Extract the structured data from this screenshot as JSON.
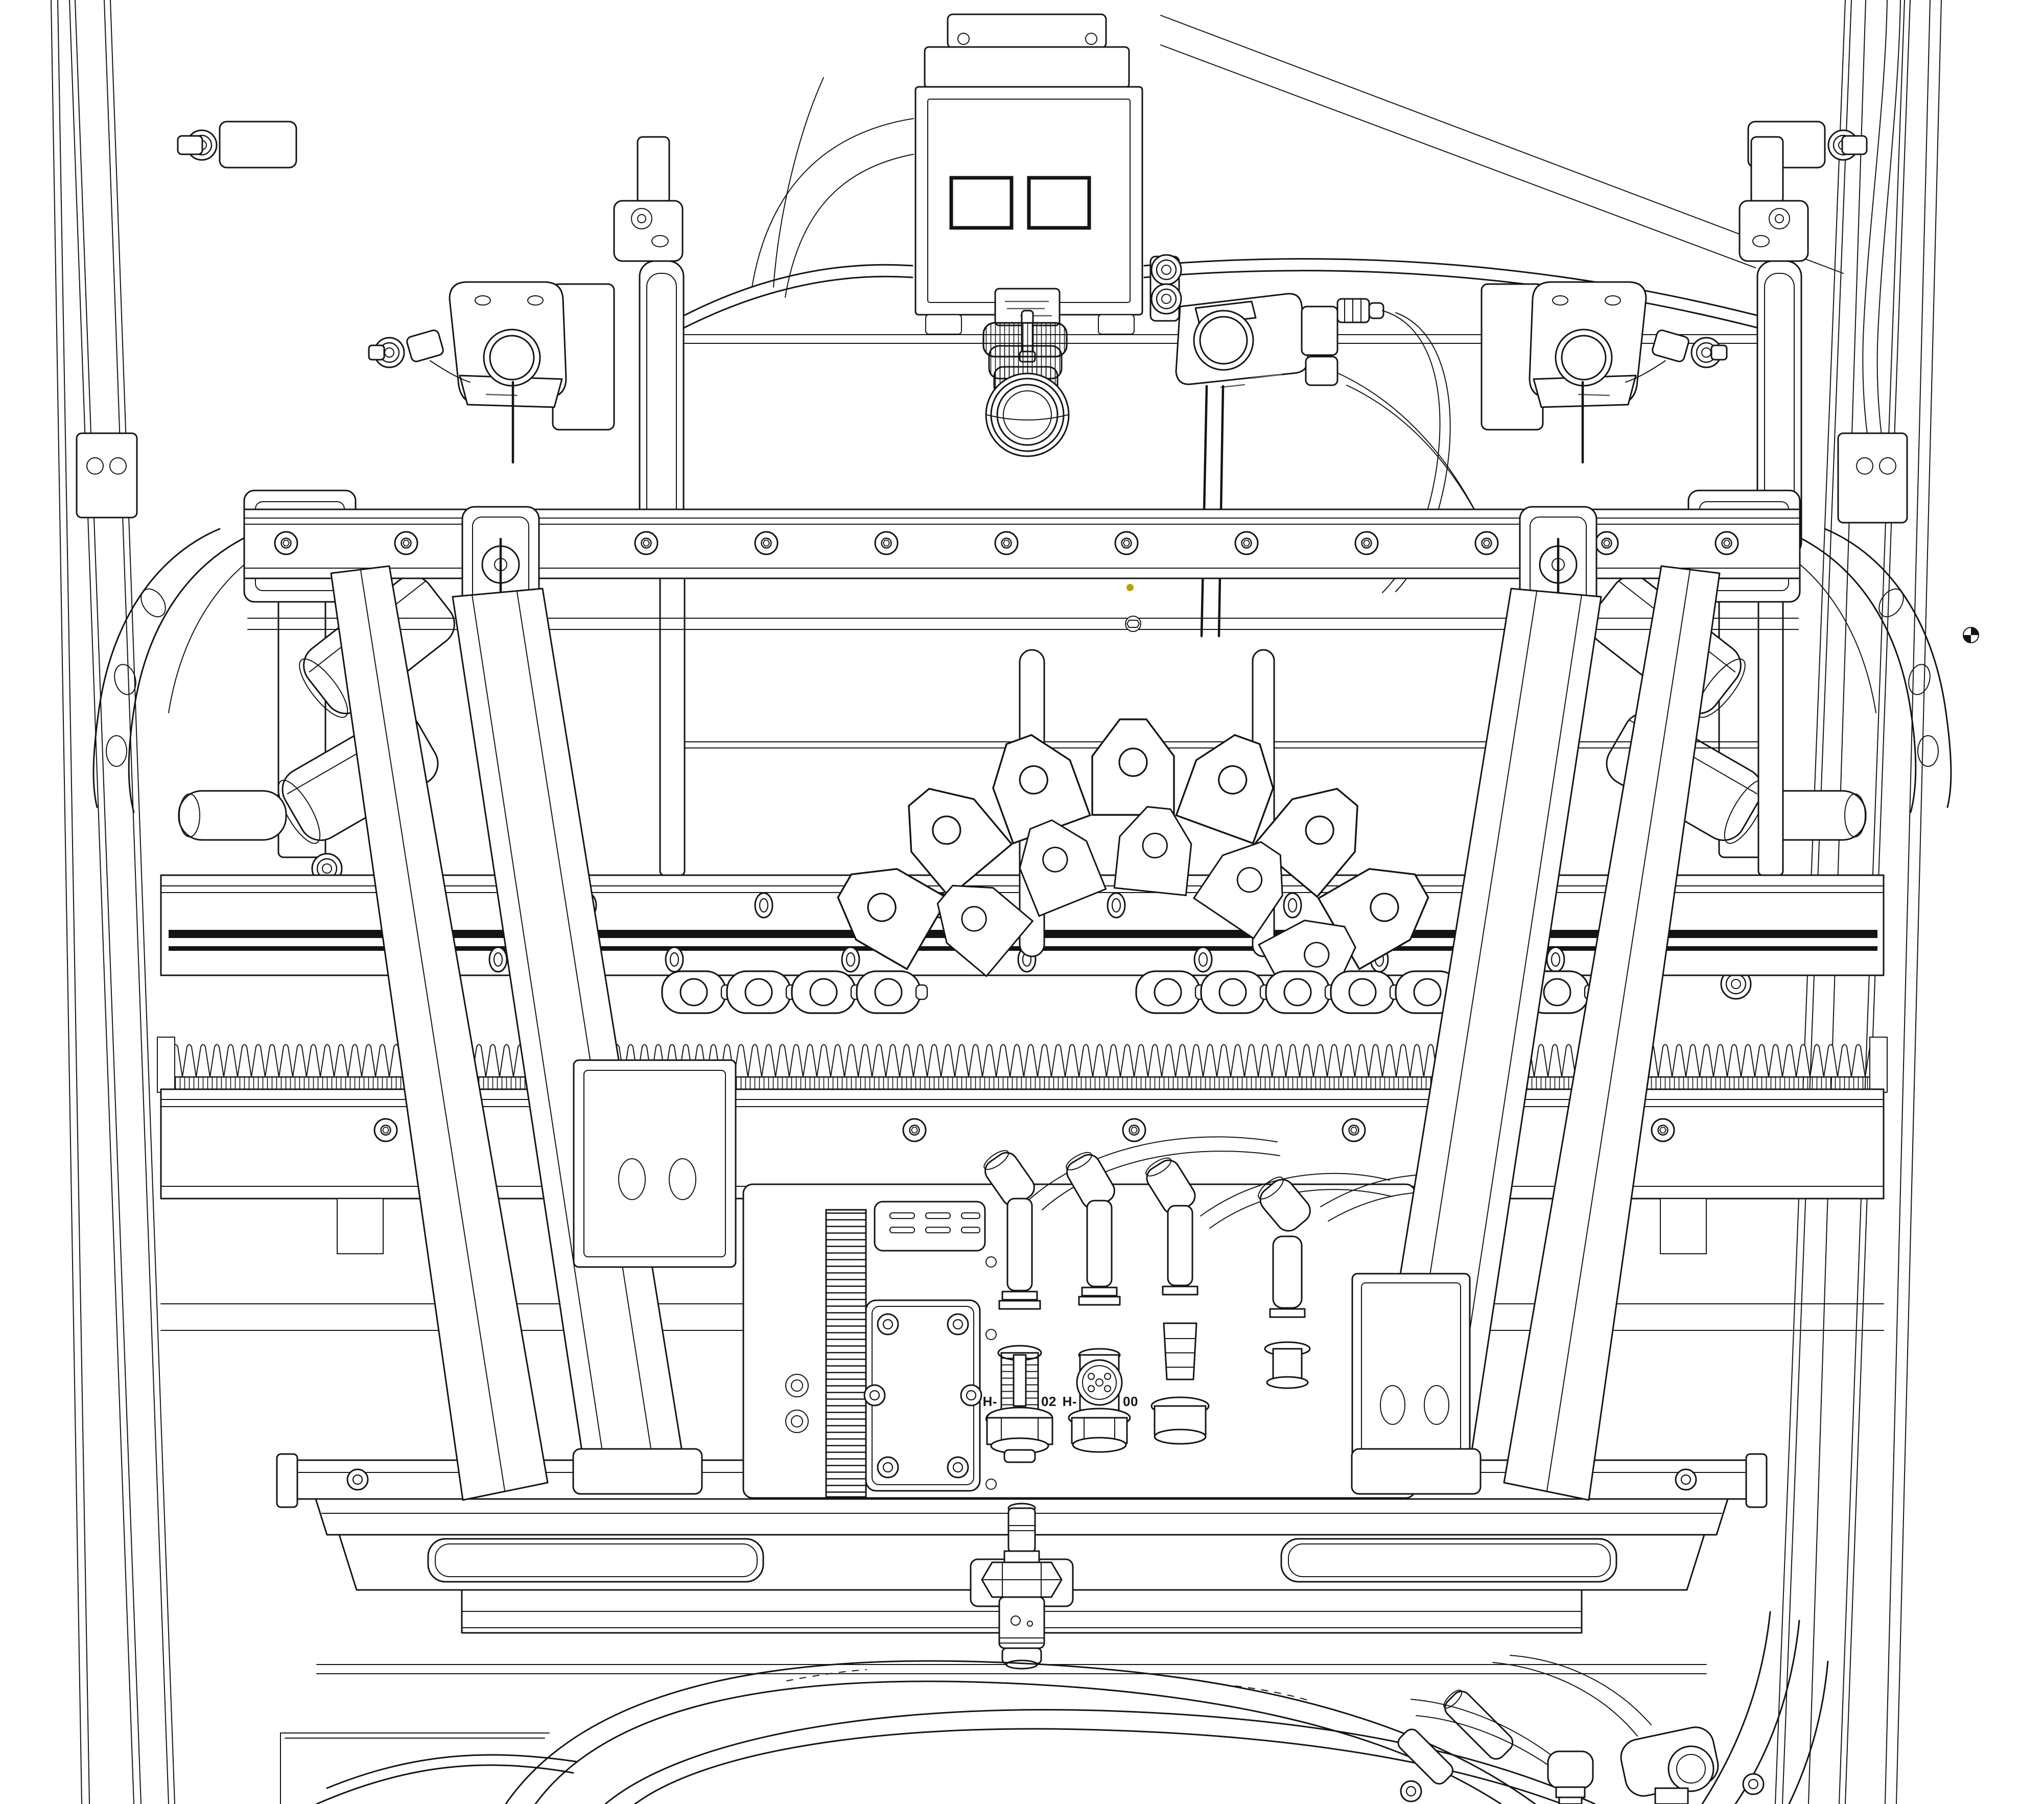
{
  "document": {
    "kind": "CAD wireframe technical drawing",
    "view": "front elevation of an industrial gantry head assembly",
    "paper_color": "#ffffff",
    "ink_color": "#141414",
    "accent_dot_color": "#b8a000"
  },
  "labels": {
    "connector_1": {
      "prefix": "H-",
      "suffix": "02"
    },
    "connector_2": {
      "prefix": "H-",
      "suffix": "00"
    }
  }
}
